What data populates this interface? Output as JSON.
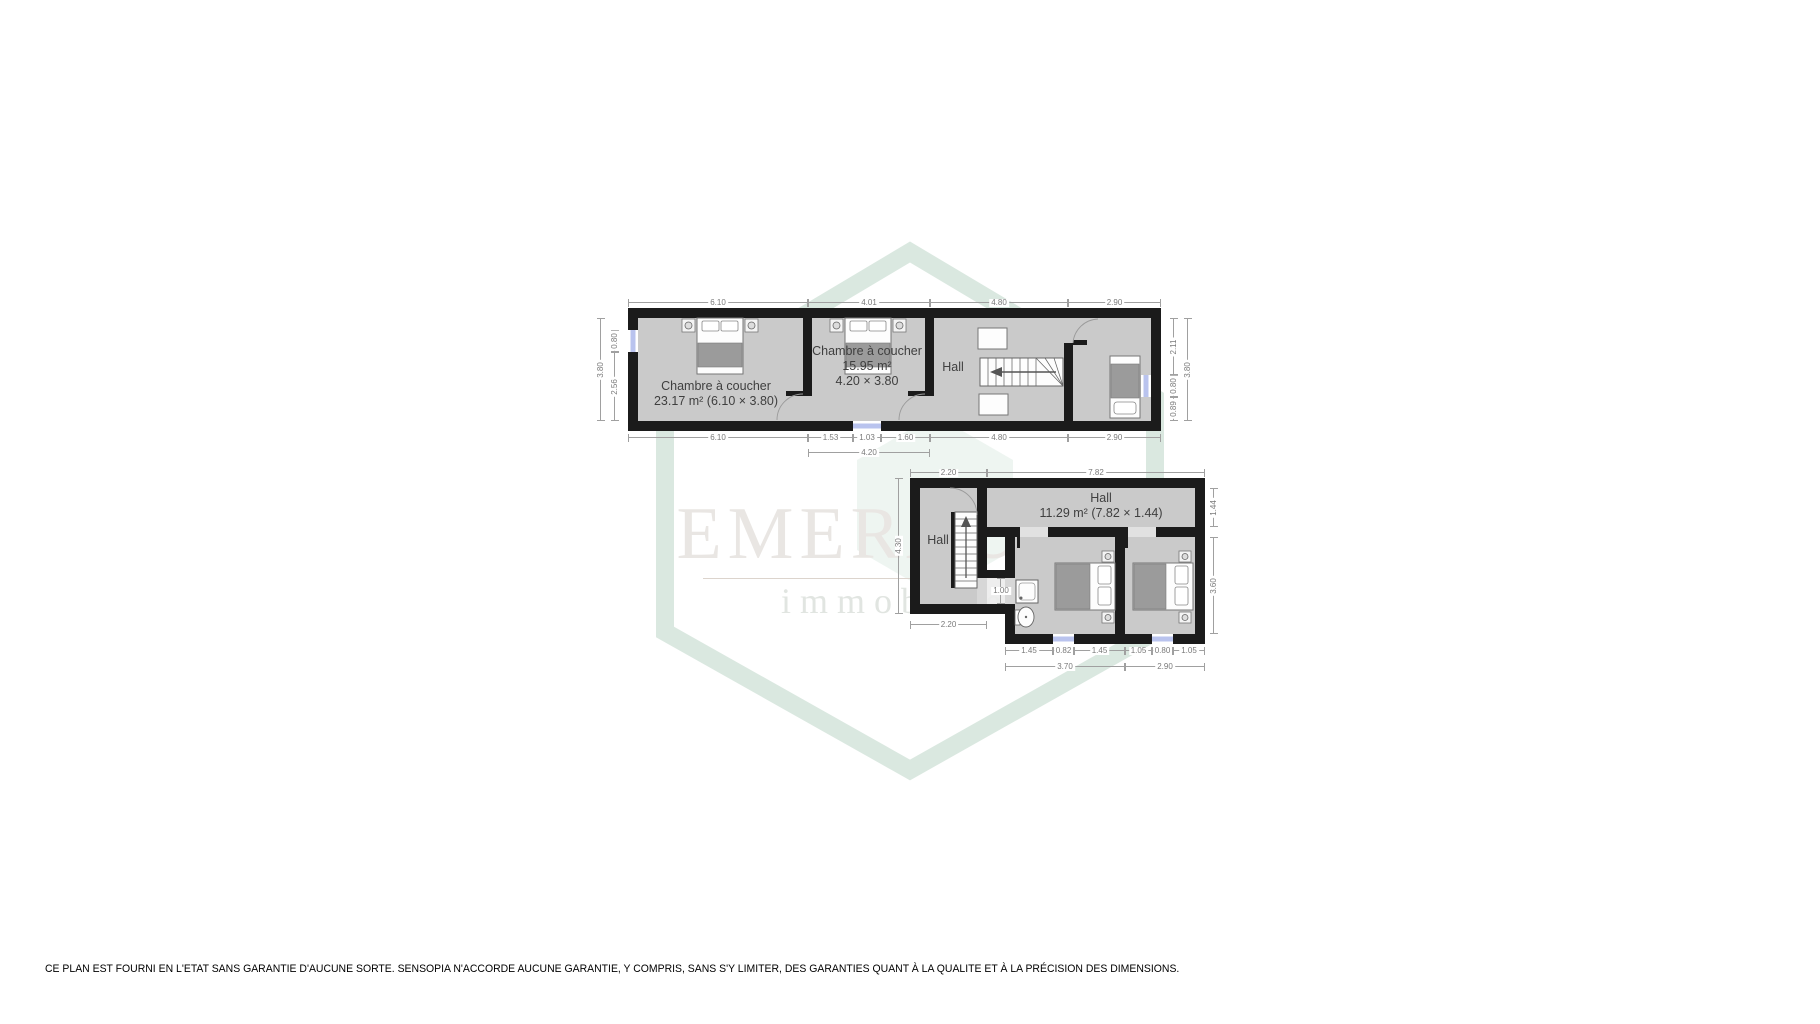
{
  "watermark": {
    "brand": "EMERAUDE",
    "tagline": "immobilier"
  },
  "disclaimer": "CE PLAN EST FOURNI EN L'ETAT SANS GARANTIE D'AUCUNE SORTE. SENSOPIA N'ACCORDE AUCUNE GARANTIE, Y COMPRIS, SANS S'Y LIMITER, DES GARANTIES QUANT À LA QUALITE ET À LA PRÉCISION DES DIMENSIONS.",
  "upper_floor": {
    "bedroom1": {
      "label": "Chambre à coucher",
      "area": "23.17 m² (6.10 × 3.80)"
    },
    "bedroom2": {
      "label": "Chambre à coucher",
      "area": "15.95 m²",
      "size": "4.20 × 3.80"
    },
    "hall": {
      "label": "Hall"
    },
    "dims": {
      "top1": "6.10",
      "top2": "4.01",
      "top3": "4.80",
      "top4": "2.90",
      "bottom1": "6.10",
      "bottom2a": "1.53",
      "bottom2b": "1.03",
      "bottom2c": "1.60",
      "bottom2": "4.20",
      "bottom3": "4.80",
      "bottom4": "2.90",
      "left_win": "0.80",
      "left2": "2.56",
      "left_total": "3.80",
      "right1": "2.11",
      "right2": "0.80",
      "right3": "0.89",
      "right_total": "3.80"
    }
  },
  "lower_floor": {
    "hall_left": {
      "label": "Hall"
    },
    "hall": {
      "label": "Hall",
      "area": "11.29 m² (7.82 × 1.44)"
    },
    "dims": {
      "top1": "2.20",
      "top2": "7.82",
      "left": "4.30",
      "hall_bottom": "2.20",
      "passage": "1.00",
      "right1": "1.44",
      "right2": "3.60",
      "bottom1a": "1.45",
      "bottom1b": "0.82",
      "bottom1c": "1.45",
      "bottom1": "3.70",
      "bottom2a": "1.05",
      "bottom2b": "0.80",
      "bottom2c": "1.05",
      "bottom2": "2.90"
    }
  }
}
